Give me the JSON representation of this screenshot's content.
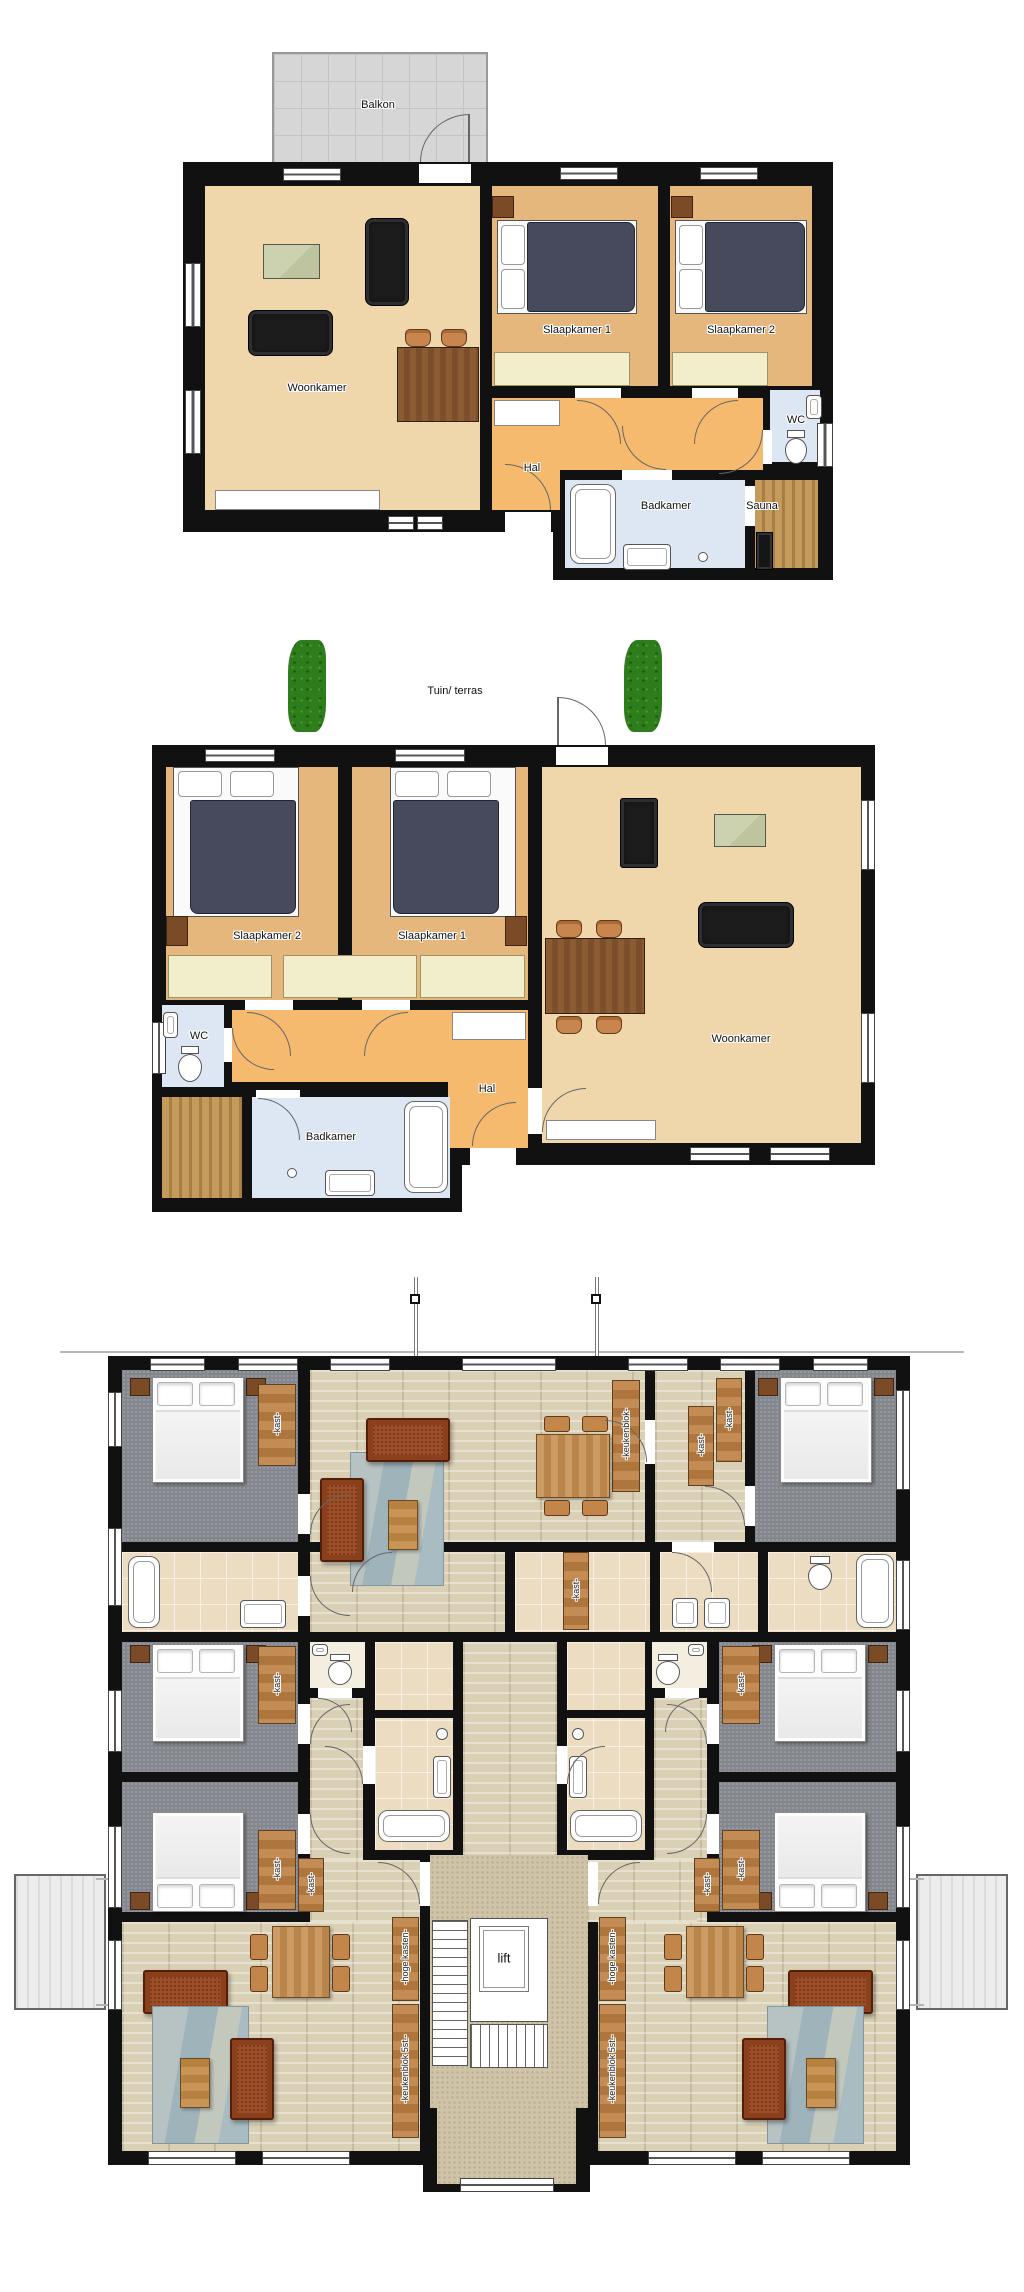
{
  "image": {
    "width": 1024,
    "height": 2292,
    "background": "#ffffff",
    "type": "architectural-floor-plans",
    "plan_count": 3
  },
  "plans": {
    "apartment_a": {
      "description": "upper apartment plan with balcony",
      "labels": {
        "balkon": "Balkon",
        "woonkamer": "Woonkamer",
        "slaapkamer1": "Slaapkamer 1",
        "slaapkamer2": "Slaapkamer 2",
        "hal": "Hal",
        "wc": "WC",
        "badkamer": "Badkamer",
        "sauna": "Sauna"
      }
    },
    "apartment_b": {
      "description": "ground-floor apartment plan with garden terrace",
      "labels": {
        "tuin_terras": "Tuin/ terras",
        "slaapkamer2": "Slaapkamer 2",
        "slaapkamer1": "Slaapkamer 1",
        "woonkamer": "Woonkamer",
        "wc": "WC",
        "hal": "Hal",
        "badkamer": "Badkamer"
      }
    },
    "building": {
      "description": "full storey plan with six bedrooms, central lift and stairs",
      "labels": {
        "lift": "lift",
        "kast": "-kast-",
        "keukenblok": "-keukenblok-",
        "hoge_kasten": "-hoge kasten-",
        "keukenblok_5st": "-keukenblok 5st.-"
      }
    }
  },
  "colors": {
    "wall": "#111111",
    "floor_living_peach": "#f0d7ab",
    "floor_bedroom_tan": "#e6b77c",
    "floor_hall_orange": "#f6ba6e",
    "floor_bath_blue": "#dde7f3",
    "sauna_wood": "#c59a5d",
    "balcony_gray": "#d6d6d6",
    "cream_cabinet": "#f2edca",
    "bed_duvet_navy": "#474a5c",
    "sofa_black": "#1c1c1c",
    "hedge_green": "#2e7d1c",
    "wood_floor_light": "#d9d0b6",
    "carpet_gray": "#84888e",
    "tile_beige": "#ecdcc2",
    "hall_carpet_speckle": "#cfc3a8",
    "sofa_rust": "#9d4e26",
    "rug_blue_gray": "#a9bcc2",
    "counter_wood": "#c28c54"
  }
}
